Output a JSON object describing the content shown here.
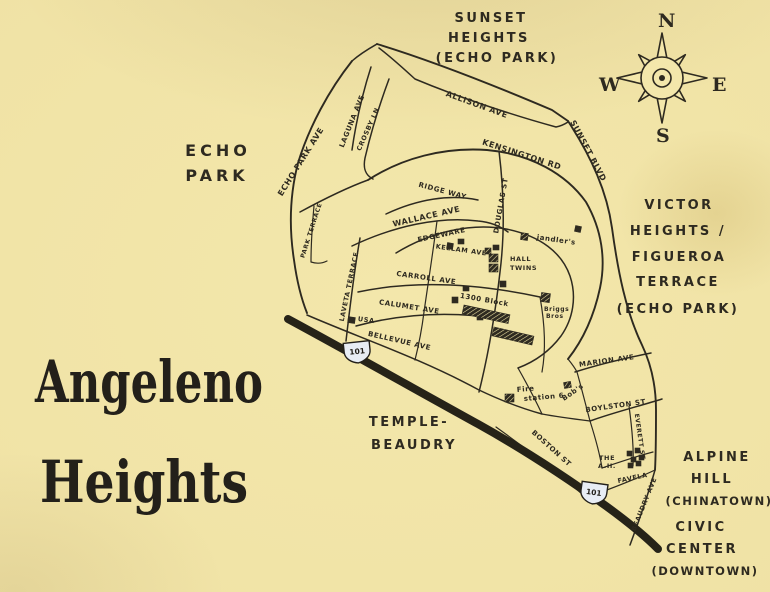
{
  "colors": {
    "paper": "#f1e5a6",
    "ink": "#2e2a20",
    "freeway": "#262318",
    "shield_fill": "#e8edf4"
  },
  "title": {
    "line1": "Angeleno",
    "line2": "Heights"
  },
  "compass": {
    "n": "N",
    "e": "E",
    "s": "S",
    "w": "W"
  },
  "neighborhoods": {
    "sunset_heights": {
      "l1": "SUNSET",
      "l2": "HEIGHTS",
      "l3": "(ECHO PARK)"
    },
    "echo_park": {
      "l1": "ECHO",
      "l2": "PARK"
    },
    "victor_heights": {
      "l1": "VICTOR",
      "l2": "HEIGHTS /",
      "l3": "FIGUEROA",
      "l4": "TERRACE",
      "l5": "(ECHO PARK)"
    },
    "temple_beaudry": {
      "l1": "TEMPLE-",
      "l2": "BEAUDRY"
    },
    "alpine_hill": {
      "l1": "ALPINE",
      "l2": "HILL",
      "l3": "(CHINATOWN)"
    },
    "civic_center": {
      "l1": "CIVIC",
      "l2": "CENTER",
      "l3": "(DOWNTOWN)"
    }
  },
  "streets": {
    "allison": "ALLISON AVE",
    "sunset": "SUNSET BLVD",
    "echo_park_ave": "ECHO PARK AVE",
    "laguna": "LAGUNA AVE",
    "crosby": "CROSBY LN",
    "kensington": "KENSINGTON RD",
    "ridge_way": "RIDGE WAY",
    "wallace": "WALLACE AVE",
    "park_terrace": "PARK TERRACE",
    "laveta": "LAVETA TERRACE",
    "edgeware": "EDGEWARE",
    "kellam": "KELLAM AVE",
    "douglas": "DOUGLAS ST",
    "carroll": "CARROLL AVE",
    "calumet": "CALUMET AVE",
    "bellevue": "BELLEVUE AVE",
    "boston": "BOSTON ST",
    "marion": "MARION AVE",
    "boylston": "BOYLSTON ST",
    "everett": "EVERETT ST",
    "beaudry": "BEAUDRY AVE"
  },
  "landmarks": {
    "block_1300": "1300 Block",
    "hall_twins": {
      "l1": "HALL",
      "l2": "TWINS"
    },
    "jandlers": "jandler's",
    "briggs": {
      "l1": "Briggs",
      "l2": "Bros"
    },
    "fire_station": {
      "l1": "Fire",
      "l2": "station 6"
    },
    "bobs": "Bob's",
    "favela": {
      "l1": "THE",
      "l2": "A.H.",
      "l3": "FAVELA"
    },
    "usa": "USA"
  },
  "freeway": {
    "shield": "101"
  }
}
